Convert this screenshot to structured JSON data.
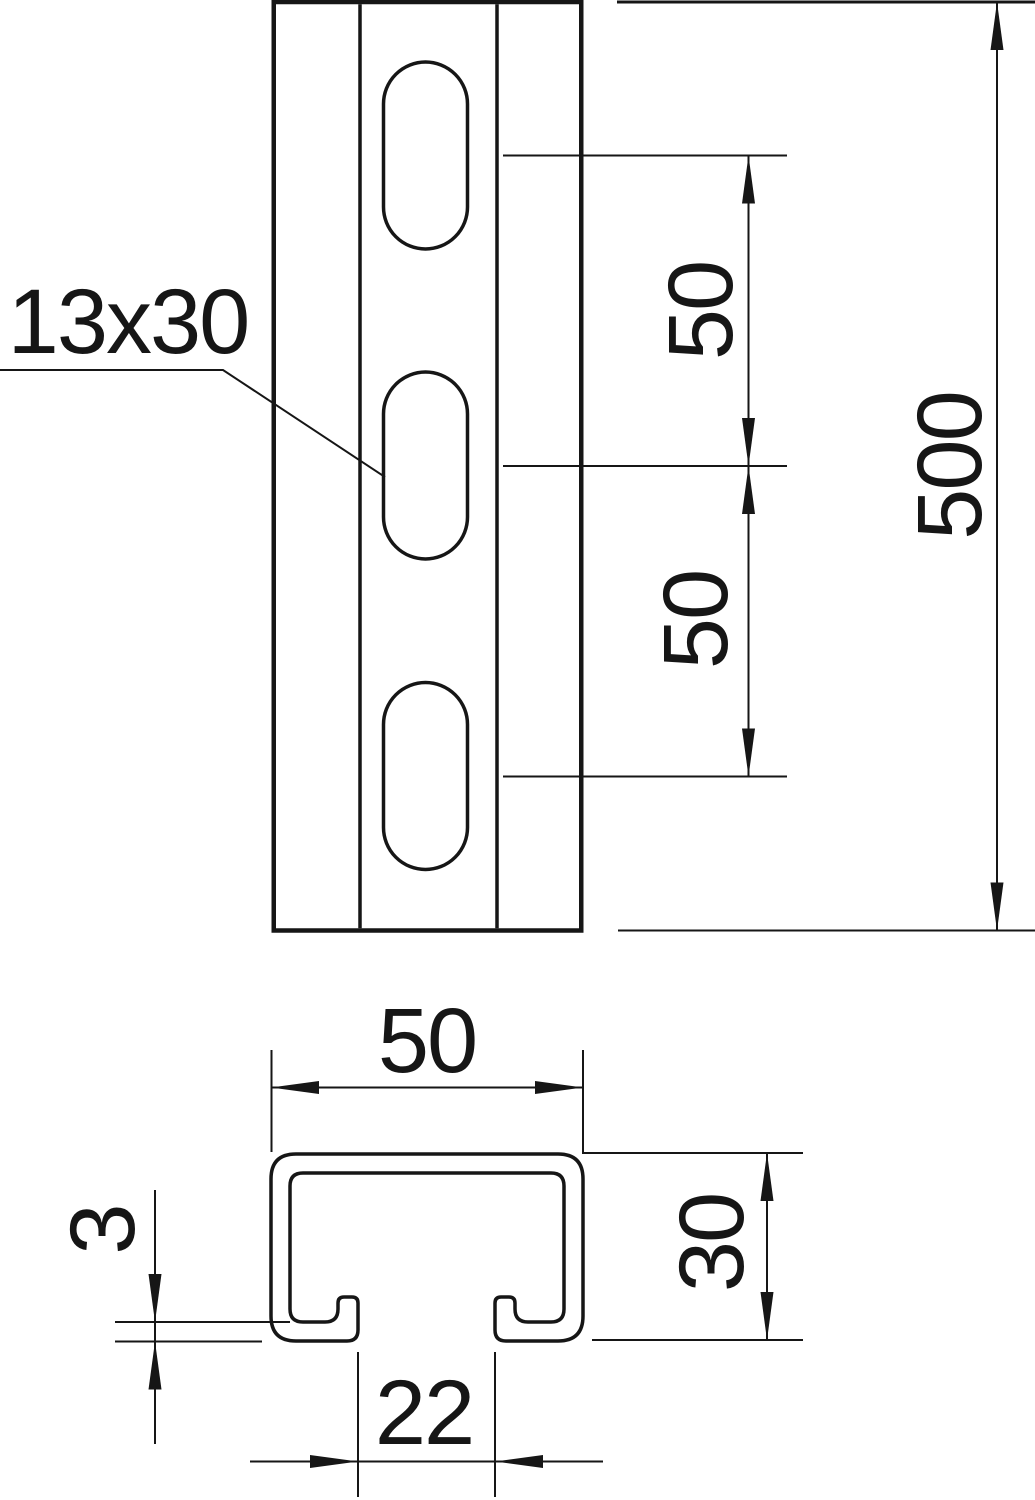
{
  "drawing": {
    "type": "technical-dimension-drawing",
    "views": {
      "front_view": "slotted channel rail with three oblong holes",
      "cross_section": "C-profile with inturned lips"
    }
  },
  "labels": {
    "slot_size": "13x30",
    "hole_pitch_upper": "50",
    "hole_pitch_lower": "50",
    "rail_length": "500",
    "profile_width": "50",
    "wall_thickness": "3",
    "profile_height": "30",
    "slot_opening": "22"
  },
  "colors": {
    "line": "#161616",
    "background": "#ffffff"
  }
}
